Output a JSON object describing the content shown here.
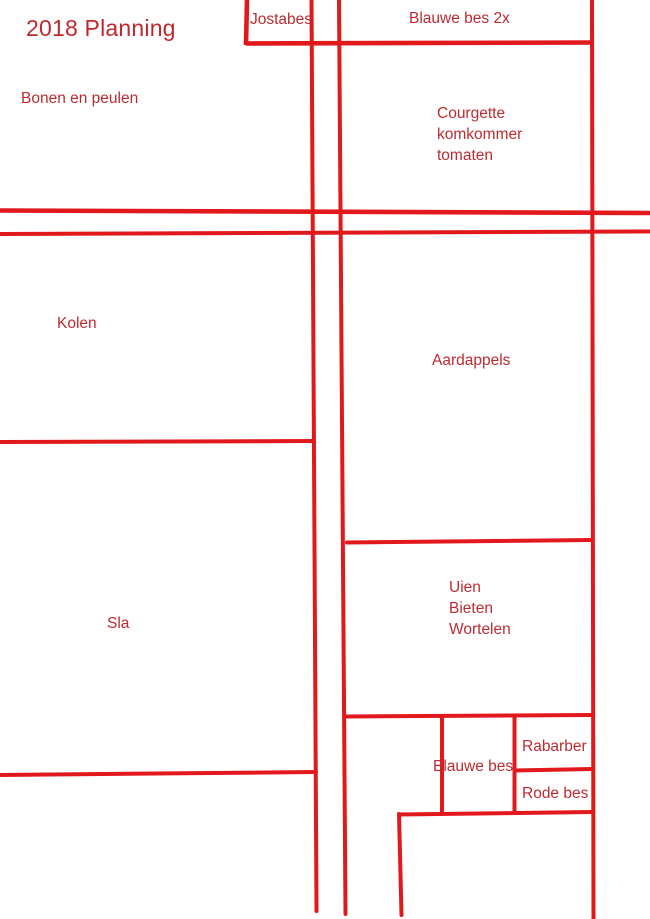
{
  "colors": {
    "line": "#e1191c",
    "text": "#bd2b31",
    "title_text": "#c1282d",
    "background": "#ffffff"
  },
  "plan": {
    "title": "2018 Planning",
    "areas": {
      "bonen_en_peulen": "Bonen en peulen",
      "jostabes": "Jostabes",
      "blauwe_bes_2x": "Blauwe bes 2x",
      "courgette": {
        "line1": "Courgette",
        "line2": "komkommer",
        "line3": "tomaten"
      },
      "kolen": "Kolen",
      "aardappels": "Aardappels",
      "sla": "Sla",
      "uien": {
        "line1": "Uien",
        "line2": "Bieten",
        "line3": "Wortelen"
      },
      "blauwe_bes": "Blauwe bes",
      "rabarber": "Rabarber",
      "rode_bes": "Rode bes"
    }
  }
}
